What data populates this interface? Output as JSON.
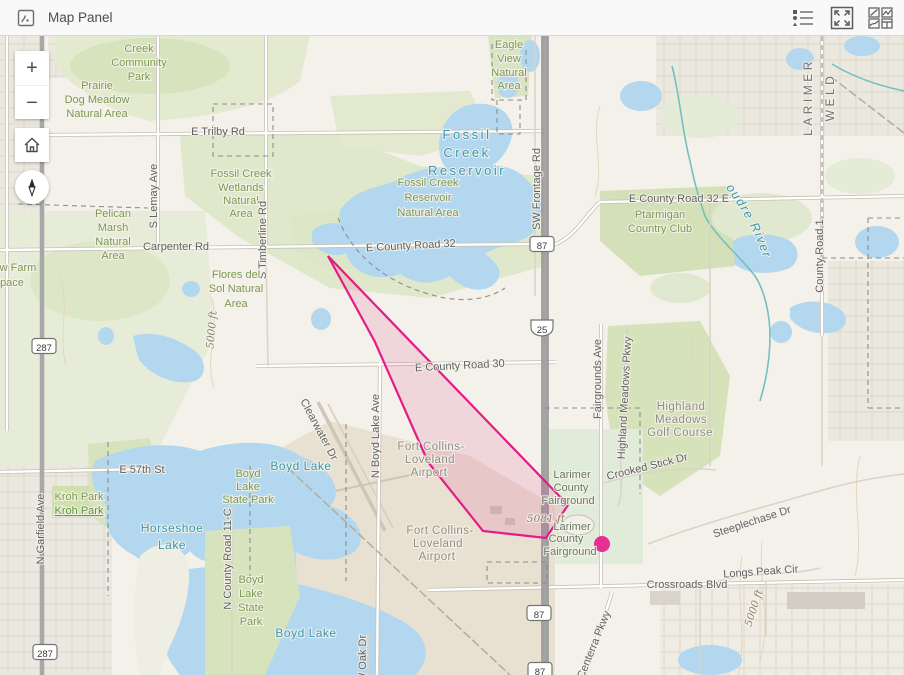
{
  "header": {
    "title": "Map Panel"
  },
  "controls": {
    "zoom_in": "+",
    "zoom_out": "−"
  },
  "overlay": {
    "stroke_color": "#e31c86",
    "fill_opacity": 0.13,
    "polygon": [
      [
        328,
        220
      ],
      [
        568,
        469
      ],
      [
        546,
        502
      ],
      [
        483,
        495
      ],
      [
        428,
        426
      ],
      [
        375,
        306
      ]
    ],
    "point": {
      "x": 602,
      "y": 508,
      "r": 8,
      "color": "#e62e93"
    }
  },
  "map": {
    "river_label": "Cache la Poudre River",
    "shields": [
      {
        "t": "287",
        "x": 44,
        "y": 310,
        "k": "us"
      },
      {
        "t": "287",
        "x": 45,
        "y": 616,
        "k": "us"
      },
      {
        "t": "87",
        "x": 542,
        "y": 208,
        "k": "us"
      },
      {
        "t": "25",
        "x": 542,
        "y": 292,
        "k": "i"
      },
      {
        "t": "87",
        "x": 539,
        "y": 577,
        "k": "us"
      },
      {
        "t": "87",
        "x": 540,
        "y": 634,
        "k": "us"
      }
    ],
    "labels": [
      {
        "t": "Creek",
        "x": 139,
        "y": 16,
        "c": "p"
      },
      {
        "t": "Community",
        "x": 139,
        "y": 30,
        "c": "p"
      },
      {
        "t": "Park",
        "x": 139,
        "y": 44,
        "c": "p"
      },
      {
        "t": "Prairie",
        "x": 97,
        "y": 53,
        "c": "p"
      },
      {
        "t": "Dog Meadow",
        "x": 97,
        "y": 67,
        "c": "p"
      },
      {
        "t": "Natural Area",
        "x": 97,
        "y": 81,
        "c": "p"
      },
      {
        "t": "Eagle",
        "x": 509,
        "y": 12,
        "c": "p"
      },
      {
        "t": "View",
        "x": 509,
        "y": 26,
        "c": "p"
      },
      {
        "t": "Natural",
        "x": 509,
        "y": 40,
        "c": "p"
      },
      {
        "t": "Area",
        "x": 509,
        "y": 53,
        "c": "p"
      },
      {
        "t": "E Trilby Rd",
        "x": 218,
        "y": 99,
        "c": "r"
      },
      {
        "t": "Fossil Creek",
        "x": 241,
        "y": 141,
        "c": "p"
      },
      {
        "t": "Wetlands",
        "x": 241,
        "y": 155,
        "c": "p"
      },
      {
        "t": "Natural",
        "x": 241,
        "y": 168,
        "c": "p"
      },
      {
        "t": "Area",
        "x": 241,
        "y": 181,
        "c": "p"
      },
      {
        "t": "Fossil",
        "x": 467,
        "y": 103,
        "c": "W"
      },
      {
        "t": "Creek",
        "x": 467,
        "y": 121,
        "c": "W"
      },
      {
        "t": "Reservoir",
        "x": 467,
        "y": 139,
        "c": "W"
      },
      {
        "t": "Fossil Creek",
        "x": 428,
        "y": 150,
        "c": "p"
      },
      {
        "t": "Reservoir",
        "x": 428,
        "y": 165,
        "c": "p"
      },
      {
        "t": "Natural Area",
        "x": 428,
        "y": 180,
        "c": "p"
      },
      {
        "t": "SW Frontage Rd",
        "x": 540,
        "y": 153,
        "c": "r",
        "r": -90
      },
      {
        "t": "E County Road 32 E",
        "x": 679,
        "y": 166,
        "c": "r"
      },
      {
        "t": "Ptarmigan",
        "x": 660,
        "y": 182,
        "c": "p"
      },
      {
        "t": "Country Club",
        "x": 660,
        "y": 196,
        "c": "p"
      },
      {
        "t": "Pelican",
        "x": 113,
        "y": 181,
        "c": "p"
      },
      {
        "t": "Marsh",
        "x": 113,
        "y": 195,
        "c": "p"
      },
      {
        "t": "Natural",
        "x": 113,
        "y": 209,
        "c": "p"
      },
      {
        "t": "Area",
        "x": 113,
        "y": 223,
        "c": "p"
      },
      {
        "t": "Carpenter Rd",
        "x": 176,
        "y": 214,
        "c": "r"
      },
      {
        "t": "E County Road 32",
        "x": 411,
        "y": 213,
        "c": "r",
        "r": -3
      },
      {
        "t": "LARIMER",
        "x": 812,
        "y": 61,
        "c": "c",
        "r": -90
      },
      {
        "t": "WELD",
        "x": 834,
        "y": 61,
        "c": "c",
        "r": -90
      },
      {
        "t": "County Road 1",
        "x": 823,
        "y": 220,
        "c": "r",
        "r": -90
      },
      {
        "t": "S Lemay Ave",
        "x": 157,
        "y": 160,
        "c": "r",
        "r": -90
      },
      {
        "t": "S Timberline Rd",
        "x": 266,
        "y": 204,
        "c": "r",
        "r": -90
      },
      {
        "t": "w Farm",
        "x": 18,
        "y": 235,
        "c": "p"
      },
      {
        "t": "pace",
        "x": 12,
        "y": 250,
        "c": "p"
      },
      {
        "t": "Flores del",
        "x": 236,
        "y": 242,
        "c": "p"
      },
      {
        "t": "Sol Natural",
        "x": 236,
        "y": 256,
        "c": "p"
      },
      {
        "t": "Area",
        "x": 236,
        "y": 271,
        "c": "p"
      },
      {
        "t": "5000 ft",
        "x": 215,
        "y": 294,
        "c": "e",
        "r": -85
      },
      {
        "t": "E County Road 30",
        "x": 460,
        "y": 333,
        "c": "r",
        "r": -3
      },
      {
        "t": "Fairgrounds Ave",
        "x": 601,
        "y": 343,
        "c": "r",
        "r": -90
      },
      {
        "t": "Highland Meadows Pkwy",
        "x": 628,
        "y": 362,
        "c": "r",
        "r": -87
      },
      {
        "t": "Highland",
        "x": 681,
        "y": 374,
        "c": "g"
      },
      {
        "t": "Meadows",
        "x": 681,
        "y": 387,
        "c": "g"
      },
      {
        "t": "Golf Course",
        "x": 680,
        "y": 400,
        "c": "g"
      },
      {
        "t": "N Boyd Lake Ave",
        "x": 379,
        "y": 400,
        "c": "r",
        "r": -90
      },
      {
        "t": "Clearwater Dr",
        "x": 316,
        "y": 395,
        "c": "r",
        "r": 62
      },
      {
        "t": "Fort Collins-",
        "x": 431,
        "y": 414,
        "c": "g"
      },
      {
        "t": "Loveland",
        "x": 430,
        "y": 427,
        "c": "g"
      },
      {
        "t": "Airport",
        "x": 429,
        "y": 440,
        "c": "g"
      },
      {
        "t": "Boyd Lake",
        "x": 301,
        "y": 434,
        "c": "w"
      },
      {
        "t": "Crooked Stick Dr",
        "x": 648,
        "y": 434,
        "c": "r",
        "r": -14
      },
      {
        "t": "E 57th St",
        "x": 142,
        "y": 437,
        "c": "r"
      },
      {
        "t": "Boyd",
        "x": 248,
        "y": 441,
        "c": "p"
      },
      {
        "t": "Lake",
        "x": 248,
        "y": 454,
        "c": "p"
      },
      {
        "t": "State Park",
        "x": 248,
        "y": 467,
        "c": "p"
      },
      {
        "t": "Larimer",
        "x": 572,
        "y": 442,
        "c": "f"
      },
      {
        "t": "County",
        "x": 571,
        "y": 455,
        "c": "f"
      },
      {
        "t": "Fairground",
        "x": 568,
        "y": 468,
        "c": "f"
      },
      {
        "t": "Kroh Park",
        "x": 79,
        "y": 464,
        "c": "p"
      },
      {
        "t": "Kroh Park",
        "x": 79,
        "y": 478,
        "c": "p2"
      },
      {
        "t": "5081 ft",
        "x": 546,
        "y": 486,
        "c": "e"
      },
      {
        "t": "Horseshoe",
        "x": 172,
        "y": 496,
        "c": "w"
      },
      {
        "t": "Lake",
        "x": 172,
        "y": 513,
        "c": "w"
      },
      {
        "t": "Fort Collins-",
        "x": 440,
        "y": 498,
        "c": "g"
      },
      {
        "t": "Loveland",
        "x": 438,
        "y": 511,
        "c": "g"
      },
      {
        "t": "Airport",
        "x": 437,
        "y": 524,
        "c": "g"
      },
      {
        "t": "Steeplechase Dr",
        "x": 753,
        "y": 489,
        "c": "r",
        "r": -18
      },
      {
        "t": "Larimer",
        "x": 572,
        "y": 494,
        "c": "f"
      },
      {
        "t": "County",
        "x": 566,
        "y": 506,
        "c": "f"
      },
      {
        "t": "Fairground",
        "x": 570,
        "y": 519,
        "c": "f"
      },
      {
        "t": "N County Road 11-C",
        "x": 231,
        "y": 523,
        "c": "r",
        "r": -90
      },
      {
        "t": "N Garfield Ave",
        "x": 44,
        "y": 493,
        "c": "r",
        "r": -90
      },
      {
        "t": "Longs Peak Cir",
        "x": 761,
        "y": 539,
        "c": "r",
        "r": -4
      },
      {
        "t": "Boyd",
        "x": 251,
        "y": 547,
        "c": "p"
      },
      {
        "t": "Lake",
        "x": 251,
        "y": 561,
        "c": "p"
      },
      {
        "t": "State",
        "x": 251,
        "y": 575,
        "c": "p"
      },
      {
        "t": "Park",
        "x": 251,
        "y": 589,
        "c": "p"
      },
      {
        "t": "Crossroads Blvd",
        "x": 687,
        "y": 552,
        "c": "r"
      },
      {
        "t": "5000 ft",
        "x": 757,
        "y": 573,
        "c": "e",
        "r": -72
      },
      {
        "t": "Boyd Lake",
        "x": 306,
        "y": 601,
        "c": "w"
      },
      {
        "t": "Centerra Pkwy",
        "x": 597,
        "y": 610,
        "c": "r",
        "r": -68
      },
      {
        "t": "W Oak Dr",
        "x": 366,
        "y": 623,
        "c": "r",
        "r": -90
      }
    ]
  }
}
